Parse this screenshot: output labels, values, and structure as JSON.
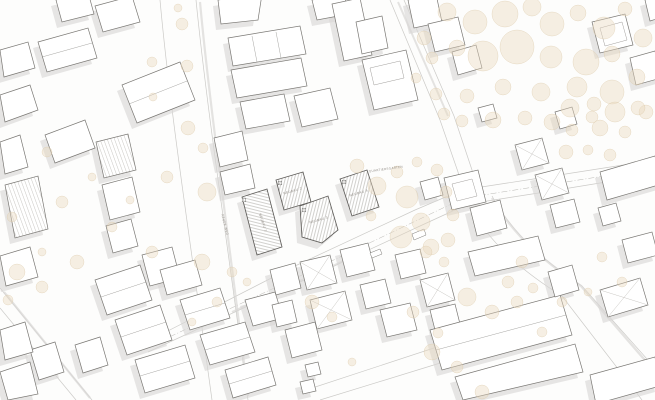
{
  "plan": {
    "type": "architectural-site-plan",
    "canvas": {
      "width": 655,
      "height": 400
    },
    "colors": {
      "background": "#fdfdfc",
      "building_fill": "#ffffff",
      "building_stroke": "#7a7874",
      "new_building_stroke": "#5f5d5a",
      "shadow": "#d8d7d5",
      "tree_fill": "#eadabf",
      "tree_stroke": "#dcc9a9",
      "street_edge": "#cbcac7",
      "hatch_line": "#9a9791",
      "stripe_line": "#c9c7c3",
      "label_text": "#95908a",
      "dash_line": "#b9b7b3"
    },
    "labels": [
      {
        "t": "NEUBAU 1",
        "x": 262,
        "y": 223,
        "r": 71,
        "s": 3.2
      },
      {
        "t": "NEUBAU 2",
        "x": 293,
        "y": 192,
        "r": -16,
        "s": 3.2
      },
      {
        "t": "NEUBAU 3",
        "x": 319,
        "y": 221,
        "r": -16,
        "s": 3.2
      },
      {
        "t": "NEUBAU 4",
        "x": 359,
        "y": 194,
        "r": -16,
        "s": 3.2
      },
      {
        "t": "QUARTIERSGARTEN",
        "x": 386,
        "y": 170,
        "r": -8,
        "s": 3.0
      },
      {
        "t": "NEUER WEG",
        "x": 224,
        "y": 225,
        "r": 76,
        "s": 3.0
      }
    ],
    "markers": [
      {
        "t": "1",
        "x": 244,
        "y": 200
      },
      {
        "t": "2",
        "x": 280,
        "y": 183
      },
      {
        "t": "3",
        "x": 304,
        "y": 210
      },
      {
        "t": "4",
        "x": 344,
        "y": 182
      }
    ],
    "streets": [
      "M160,0 C170,110 190,240 212,400",
      "M196,0 C207,110 227,240 248,400",
      "M148,352 L300,282 L420,226 L468,204 L545,192 L655,174",
      "M158,336 L295,266 L415,210 L462,190 L540,178 L655,160",
      "M390,0 L440,120 L458,172 L466,200",
      "M404,0 L454,116 L472,170 L478,196",
      "M468,204 C492,248 530,276 562,296 L642,400",
      "M492,196 C516,240 552,266 582,286 L655,368",
      "M300,392 L440,346 L552,312",
      "M320,400 L450,360 L560,326",
      "M0,288 L92,400",
      "M0,308 L76,400"
    ],
    "street_shadows": [
      {
        "d": "M200,2 C210,110 229,238 248,396",
        "w": 2.2
      },
      {
        "d": "M492,198 C516,240 551,266 581,286 L650,366",
        "w": 2.4
      },
      {
        "d": "M232,312 L350,258",
        "w": 2.0
      },
      {
        "d": "M4,292 L90,398",
        "w": 2.2
      },
      {
        "d": "M398,2 L448,116",
        "w": 2.0
      }
    ],
    "boundary_dash": "M150,346 L300,276 L464,198 L655,168",
    "islands": [
      "412,234 424,229 426,235 414,240",
      "370,253 380,249 382,254 372,258"
    ],
    "buildings": [
      {
        "p": "38,42 88,28 97,58 47,72",
        "ln": [
          "42,57 92,43"
        ]
      },
      {
        "p": "95,6 132,-4 140,22 103,32"
      },
      {
        "p": "56,0 88,-8 94,14 62,22"
      },
      {
        "p": "122,85 180,62 195,100 137,123",
        "ln": [
          "129,104 187,81"
        ]
      },
      {
        "p": "45,135 85,120 95,148 55,163"
      },
      {
        "p": "0,95 30,85 38,110 5,122"
      },
      {
        "p": "0,50 28,42 35,68 4,77"
      },
      {
        "p": "0,142 20,135 28,167 5,174"
      },
      {
        "p": "218,0 262,-6 258,20 221,24"
      },
      {
        "p": "228,38 300,26 306,54 233,66",
        "ln": [
          "252,36 257,62",
          "276,32 281,58"
        ]
      },
      {
        "p": "231,70 301,58 307,86 237,98"
      },
      {
        "p": "312,0 344,-6 349,14 317,20"
      },
      {
        "p": "332,4 360,-2 372,55 344,61"
      },
      {
        "p": "356,22 382,16 388,48 362,54"
      },
      {
        "p": "362,60 406,50 418,100 374,110",
        "inner": "M370,68 L400,61 L404,78 L374,85 Z"
      },
      {
        "p": "408,0 436,-6 442,22 414,28"
      },
      {
        "p": "428,24 458,17 465,45 435,52"
      },
      {
        "p": "452,52 476,45 482,68 458,75"
      },
      {
        "p": "294,96 330,88 338,119 302,127"
      },
      {
        "p": "240,102 284,94 290,121 246,129"
      },
      {
        "p": "96,142 128,134 136,170 104,178",
        "pat": "stripes-a"
      },
      {
        "p": "102,185 132,177 140,212 110,220"
      },
      {
        "p": "106,226 131,219 138,246 113,253"
      },
      {
        "p": "5,185 38,176 48,229 15,238",
        "pat": "stripes-a"
      },
      {
        "p": "0,256 30,247 38,277 6,286"
      },
      {
        "p": "142,255 172,247 180,278 150,286"
      },
      {
        "p": "214,138 242,131 248,160 220,167"
      },
      {
        "p": "220,172 250,164 255,188 225,195"
      },
      {
        "p": "30,350 55,342 64,372 39,380"
      },
      {
        "p": "95,280 140,265 152,300 107,315",
        "ln": [
          "101,297 146,282"
        ]
      },
      {
        "p": "115,320 160,305 172,340 127,355",
        "ln": [
          "121,337 166,322"
        ]
      },
      {
        "p": "135,360 185,345 195,378 145,393",
        "ln": [
          "140,376 190,361"
        ]
      },
      {
        "p": "180,300 220,288 230,318 190,330",
        "ln": [
          "185,315 225,303"
        ]
      },
      {
        "p": "200,335 245,322 255,352 210,365",
        "ln": [
          "205,350 250,337"
        ]
      },
      {
        "p": "225,370 268,357 276,385 233,398",
        "ln": [
          "229,384 272,371"
        ]
      },
      {
        "p": "75,345 100,337 108,365 83,373"
      },
      {
        "p": "160,270 195,260 202,285 167,295"
      },
      {
        "p": "0,330 25,322 33,352 5,360"
      },
      {
        "p": "0,372 30,362 38,394 8,400"
      },
      {
        "p": "245,300 275,292 283,318 253,326"
      },
      {
        "p": "300,262 330,255 337,283 307,290",
        "hip": true
      },
      {
        "p": "340,250 368,243 375,270 347,277"
      },
      {
        "p": "310,300 345,291 352,320 317,329",
        "hip": true
      },
      {
        "p": "360,285 385,279 391,303 366,309"
      },
      {
        "p": "380,310 410,303 417,330 387,337"
      },
      {
        "p": "395,255 420,249 426,273 401,279"
      },
      {
        "p": "420,280 448,273 455,300 427,307",
        "hip": true
      },
      {
        "p": "430,310 455,304 461,328 436,334"
      },
      {
        "p": "285,330 315,322 322,350 292,358"
      },
      {
        "p": "270,270 295,263 301,288 276,295"
      },
      {
        "p": "272,305 292,300 297,322 277,327"
      },
      {
        "p": "305,365 318,362 321,374 308,377"
      },
      {
        "p": "300,382 313,379 316,391 303,394"
      },
      {
        "p": "430,330 560,295 572,335 442,370",
        "ln": [
          "436,350 566,315"
        ]
      },
      {
        "p": "455,377 575,344 583,372 463,400"
      },
      {
        "p": "590,375 655,357 660,386 596,404"
      },
      {
        "p": "468,252 538,236 545,260 475,276"
      },
      {
        "p": "548,272 572,265 579,290 555,297"
      },
      {
        "p": "600,290 640,278 648,305 608,317",
        "hip": true
      },
      {
        "p": "622,240 652,232 658,255 628,263"
      },
      {
        "p": "600,172 655,156 662,184 607,200"
      },
      {
        "p": "598,208 616,203 621,221 603,226"
      },
      {
        "p": "444,178 478,170 486,202 452,210",
        "inner": "M452,184 L472,179 L477,196 L457,201 Z"
      },
      {
        "p": "470,208 500,200 507,228 477,236"
      },
      {
        "p": "420,182 438,177 443,195 425,200"
      },
      {
        "p": "515,145 542,138 549,163 522,170",
        "hip": true
      },
      {
        "p": "535,175 562,168 569,193 542,200",
        "hip": true
      },
      {
        "p": "550,205 574,199 580,222 556,228"
      },
      {
        "p": "592,22 625,14 633,45 600,53",
        "inner": "M600,28 L622,22 L627,40 L605,46 Z"
      },
      {
        "p": "630,58 655,51 661,78 636,85"
      },
      {
        "p": "645,0 662,-5 666,16 650,21"
      },
      {
        "p": "478,108 493,104 497,118 482,122"
      },
      {
        "p": "555,112 572,107 577,124 560,129"
      },
      {
        "p": "242,197 267,189 282,247 257,255",
        "k": "n",
        "pat": "hatch-a"
      },
      {
        "p": "276,180 303,172 311,202 284,210",
        "k": "n",
        "pat": "hatch-b"
      },
      {
        "p": "300,206 328,196 338,230 322,243 302,237",
        "k": "n",
        "pat": "hatch-b"
      },
      {
        "p": "340,179 367,170 379,207 352,216",
        "k": "n",
        "pat": "hatch-b"
      }
    ],
    "trees": [
      [
        447,
        12,
        9
      ],
      [
        475,
        22,
        12
      ],
      [
        505,
        14,
        13
      ],
      [
        532,
        7,
        9
      ],
      [
        552,
        24,
        12
      ],
      [
        578,
        13,
        8
      ],
      [
        604,
        28,
        11
      ],
      [
        625,
        9,
        7
      ],
      [
        643,
        38,
        9
      ],
      [
        457,
        48,
        8
      ],
      [
        483,
        56,
        15
      ],
      [
        517,
        47,
        17
      ],
      [
        551,
        57,
        11
      ],
      [
        586,
        62,
        13
      ],
      [
        612,
        54,
        8
      ],
      [
        577,
        87,
        10
      ],
      [
        541,
        92,
        9
      ],
      [
        503,
        87,
        8
      ],
      [
        467,
        96,
        7
      ],
      [
        612,
        92,
        12
      ],
      [
        637,
        77,
        8
      ],
      [
        646,
        112,
        7
      ],
      [
        592,
        117,
        6
      ],
      [
        552,
        122,
        8
      ],
      [
        525,
        118,
        7
      ],
      [
        493,
        120,
        8
      ],
      [
        462,
        121,
        6
      ],
      [
        570,
        108,
        9
      ],
      [
        594,
        104,
        7
      ],
      [
        615,
        112,
        10
      ],
      [
        638,
        108,
        7
      ],
      [
        572,
        130,
        6
      ],
      [
        600,
        128,
        8
      ],
      [
        625,
        132,
        6
      ],
      [
        566,
        152,
        7
      ],
      [
        588,
        150,
        5
      ],
      [
        610,
        155,
        6
      ],
      [
        357,
        166,
        7
      ],
      [
        377,
        186,
        9
      ],
      [
        397,
        172,
        6
      ],
      [
        407,
        197,
        11
      ],
      [
        421,
        222,
        9
      ],
      [
        401,
        237,
        11
      ],
      [
        431,
        247,
        8
      ],
      [
        371,
        216,
        5
      ],
      [
        446,
        192,
        6
      ],
      [
        417,
        162,
        5
      ],
      [
        437,
        170,
        6
      ],
      [
        453,
        215,
        6
      ],
      [
        448,
        240,
        7
      ],
      [
        424,
        38,
        7
      ],
      [
        432,
        58,
        6
      ],
      [
        416,
        78,
        5
      ],
      [
        436,
        94,
        6
      ],
      [
        444,
        114,
        6
      ],
      [
        426,
        252,
        6
      ],
      [
        444,
        262,
        5
      ],
      [
        182,
        24,
        6
      ],
      [
        152,
        62,
        5
      ],
      [
        187,
        66,
        6
      ],
      [
        153,
        97,
        4
      ],
      [
        188,
        128,
        7
      ],
      [
        203,
        148,
        5
      ],
      [
        167,
        177,
        6
      ],
      [
        207,
        192,
        9
      ],
      [
        152,
        252,
        6
      ],
      [
        202,
        262,
        8
      ],
      [
        217,
        302,
        5
      ],
      [
        192,
        322,
        4
      ],
      [
        178,
        8,
        4
      ],
      [
        47,
        152,
        5
      ],
      [
        92,
        177,
        4
      ],
      [
        62,
        202,
        6
      ],
      [
        112,
        227,
        5
      ],
      [
        42,
        252,
        4
      ],
      [
        77,
        262,
        7
      ],
      [
        12,
        217,
        5
      ],
      [
        130,
        200,
        4
      ],
      [
        17,
        272,
        8
      ],
      [
        42,
        287,
        6
      ],
      [
        8,
        300,
        5
      ],
      [
        232,
        272,
        5
      ],
      [
        247,
        282,
        4
      ],
      [
        312,
        302,
        7
      ],
      [
        332,
        317,
        5
      ],
      [
        467,
        297,
        9
      ],
      [
        492,
        312,
        7
      ],
      [
        517,
        302,
        6
      ],
      [
        542,
        332,
        5
      ],
      [
        432,
        352,
        8
      ],
      [
        457,
        367,
        6
      ],
      [
        482,
        392,
        7
      ],
      [
        562,
        302,
        5
      ],
      [
        588,
        292,
        4
      ],
      [
        622,
        282,
        5
      ],
      [
        522,
        262,
        6
      ],
      [
        602,
        257,
        5
      ],
      [
        413,
        312,
        6
      ],
      [
        438,
        333,
        5
      ],
      [
        352,
        362,
        4
      ],
      [
        508,
        282,
        6
      ],
      [
        533,
        288,
        5
      ]
    ]
  }
}
